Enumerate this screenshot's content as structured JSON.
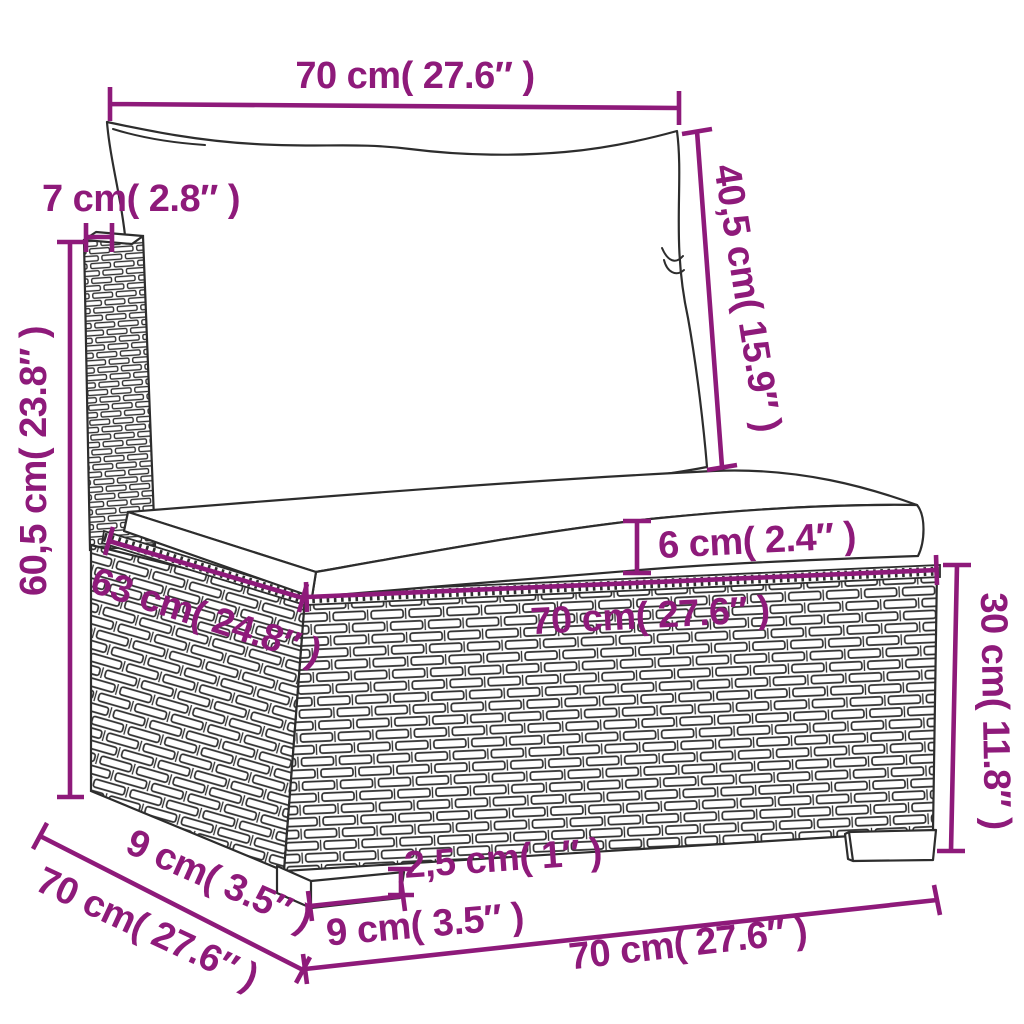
{
  "diagram": {
    "title": "sofa-section-dimension-diagram",
    "accent_color": "#8e1a7a",
    "line_color": "#2d2d2d",
    "background_color": "#ffffff",
    "dimensions": [
      {
        "id": "back-width",
        "label": "70 cm( 27.6″ )"
      },
      {
        "id": "back-cushion-height",
        "label": "40,5 cm( 15.9″ )"
      },
      {
        "id": "back-panel-thickness",
        "label": "7 cm( 2.8″ )"
      },
      {
        "id": "total-height",
        "label": "60,5 cm( 23.8″ )"
      },
      {
        "id": "seat-depth",
        "label": "63 cm( 24.8″ )"
      },
      {
        "id": "seat-cushion-thickness",
        "label": "6 cm( 2.4″ )"
      },
      {
        "id": "seat-width",
        "label": "70 cm( 27.6″ )"
      },
      {
        "id": "base-height",
        "label": "30 cm( 11.8″ )"
      },
      {
        "id": "leg-inset-depth",
        "label": "9 cm( 3.5″ )"
      },
      {
        "id": "total-depth",
        "label": "70 cm( 27.6″ )"
      },
      {
        "id": "leg-height",
        "label": "2,5 cm( 1″ )"
      },
      {
        "id": "leg-width",
        "label": "9 cm( 3.5″ )"
      },
      {
        "id": "bottom-width",
        "label": "70 cm( 27.6″ )"
      }
    ]
  }
}
